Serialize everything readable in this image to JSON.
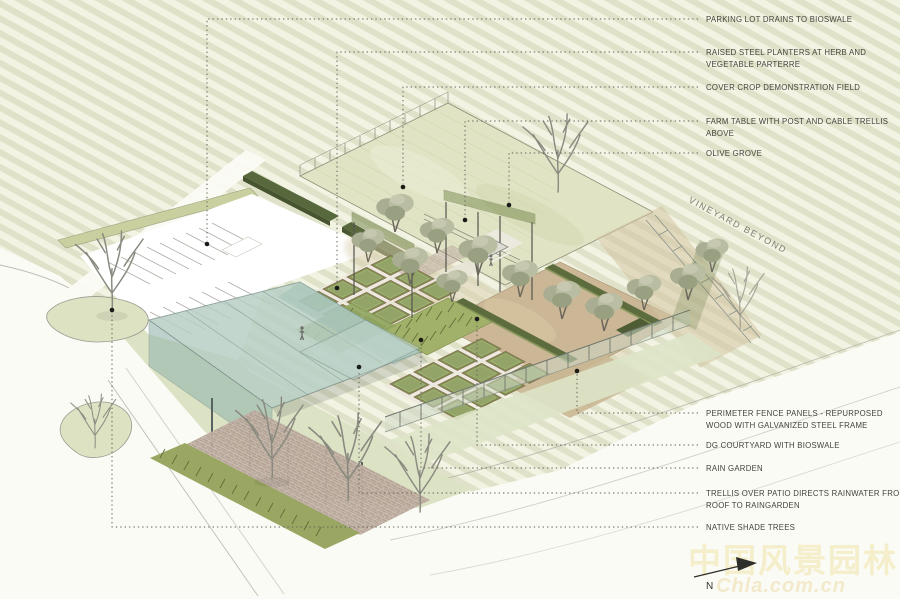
{
  "callouts": {
    "top": [
      {
        "id": "parking",
        "lines": [
          "PARKING LOT DRAINS TO BIOSWALE"
        ]
      },
      {
        "id": "raised_planters",
        "lines": [
          "RAISED STEEL PLANTERS AT HERB AND",
          "VEGETABLE PARTERRE"
        ]
      },
      {
        "id": "cover_crop",
        "lines": [
          "COVER CROP DEMONSTRATION FIELD"
        ]
      },
      {
        "id": "farm_table",
        "lines": [
          "FARM TABLE WITH POST AND CABLE TRELLIS",
          "ABOVE"
        ]
      },
      {
        "id": "olive_grove",
        "lines": [
          "OLIVE GROVE"
        ]
      }
    ],
    "bottom": [
      {
        "id": "perimeter_fence",
        "lines": [
          "PERIMETER FENCE PANELS - REPURPOSED",
          "WOOD WITH GALVANIZED STEEL FRAME"
        ]
      },
      {
        "id": "dg_courtyard",
        "lines": [
          "DG COURTYARD WITH BIOSWALE"
        ]
      },
      {
        "id": "rain_garden",
        "lines": [
          "RAIN GARDEN"
        ]
      },
      {
        "id": "trellis_patio",
        "lines": [
          "TRELLIS OVER PATIO DIRECTS RAINWATER FROM",
          "ROOF TO RAINGARDEN"
        ]
      },
      {
        "id": "native_shade_trees",
        "lines": [
          "NATIVE SHADE TREES"
        ]
      }
    ]
  },
  "annotations": {
    "vineyard_note": "VINEYARD BEYOND"
  },
  "compass": {
    "north_label": "N"
  },
  "watermark": {
    "line1": "中国风景园林网",
    "line2": "Chla.com.cn"
  },
  "colors": {
    "vineyard_stripe": "#dfe1c8",
    "cream_ground": "#f2f3e2",
    "cover_crop_field": "#e0e4c5",
    "dg_tan": "#cbb795",
    "roof_teal": "#b6cec4",
    "planter_green": "#7e9153",
    "hedge_green": "#57683c",
    "fence_pale": "#cdd8c6",
    "lawn_green": "#dce3c5",
    "label_text": "#44443e"
  }
}
